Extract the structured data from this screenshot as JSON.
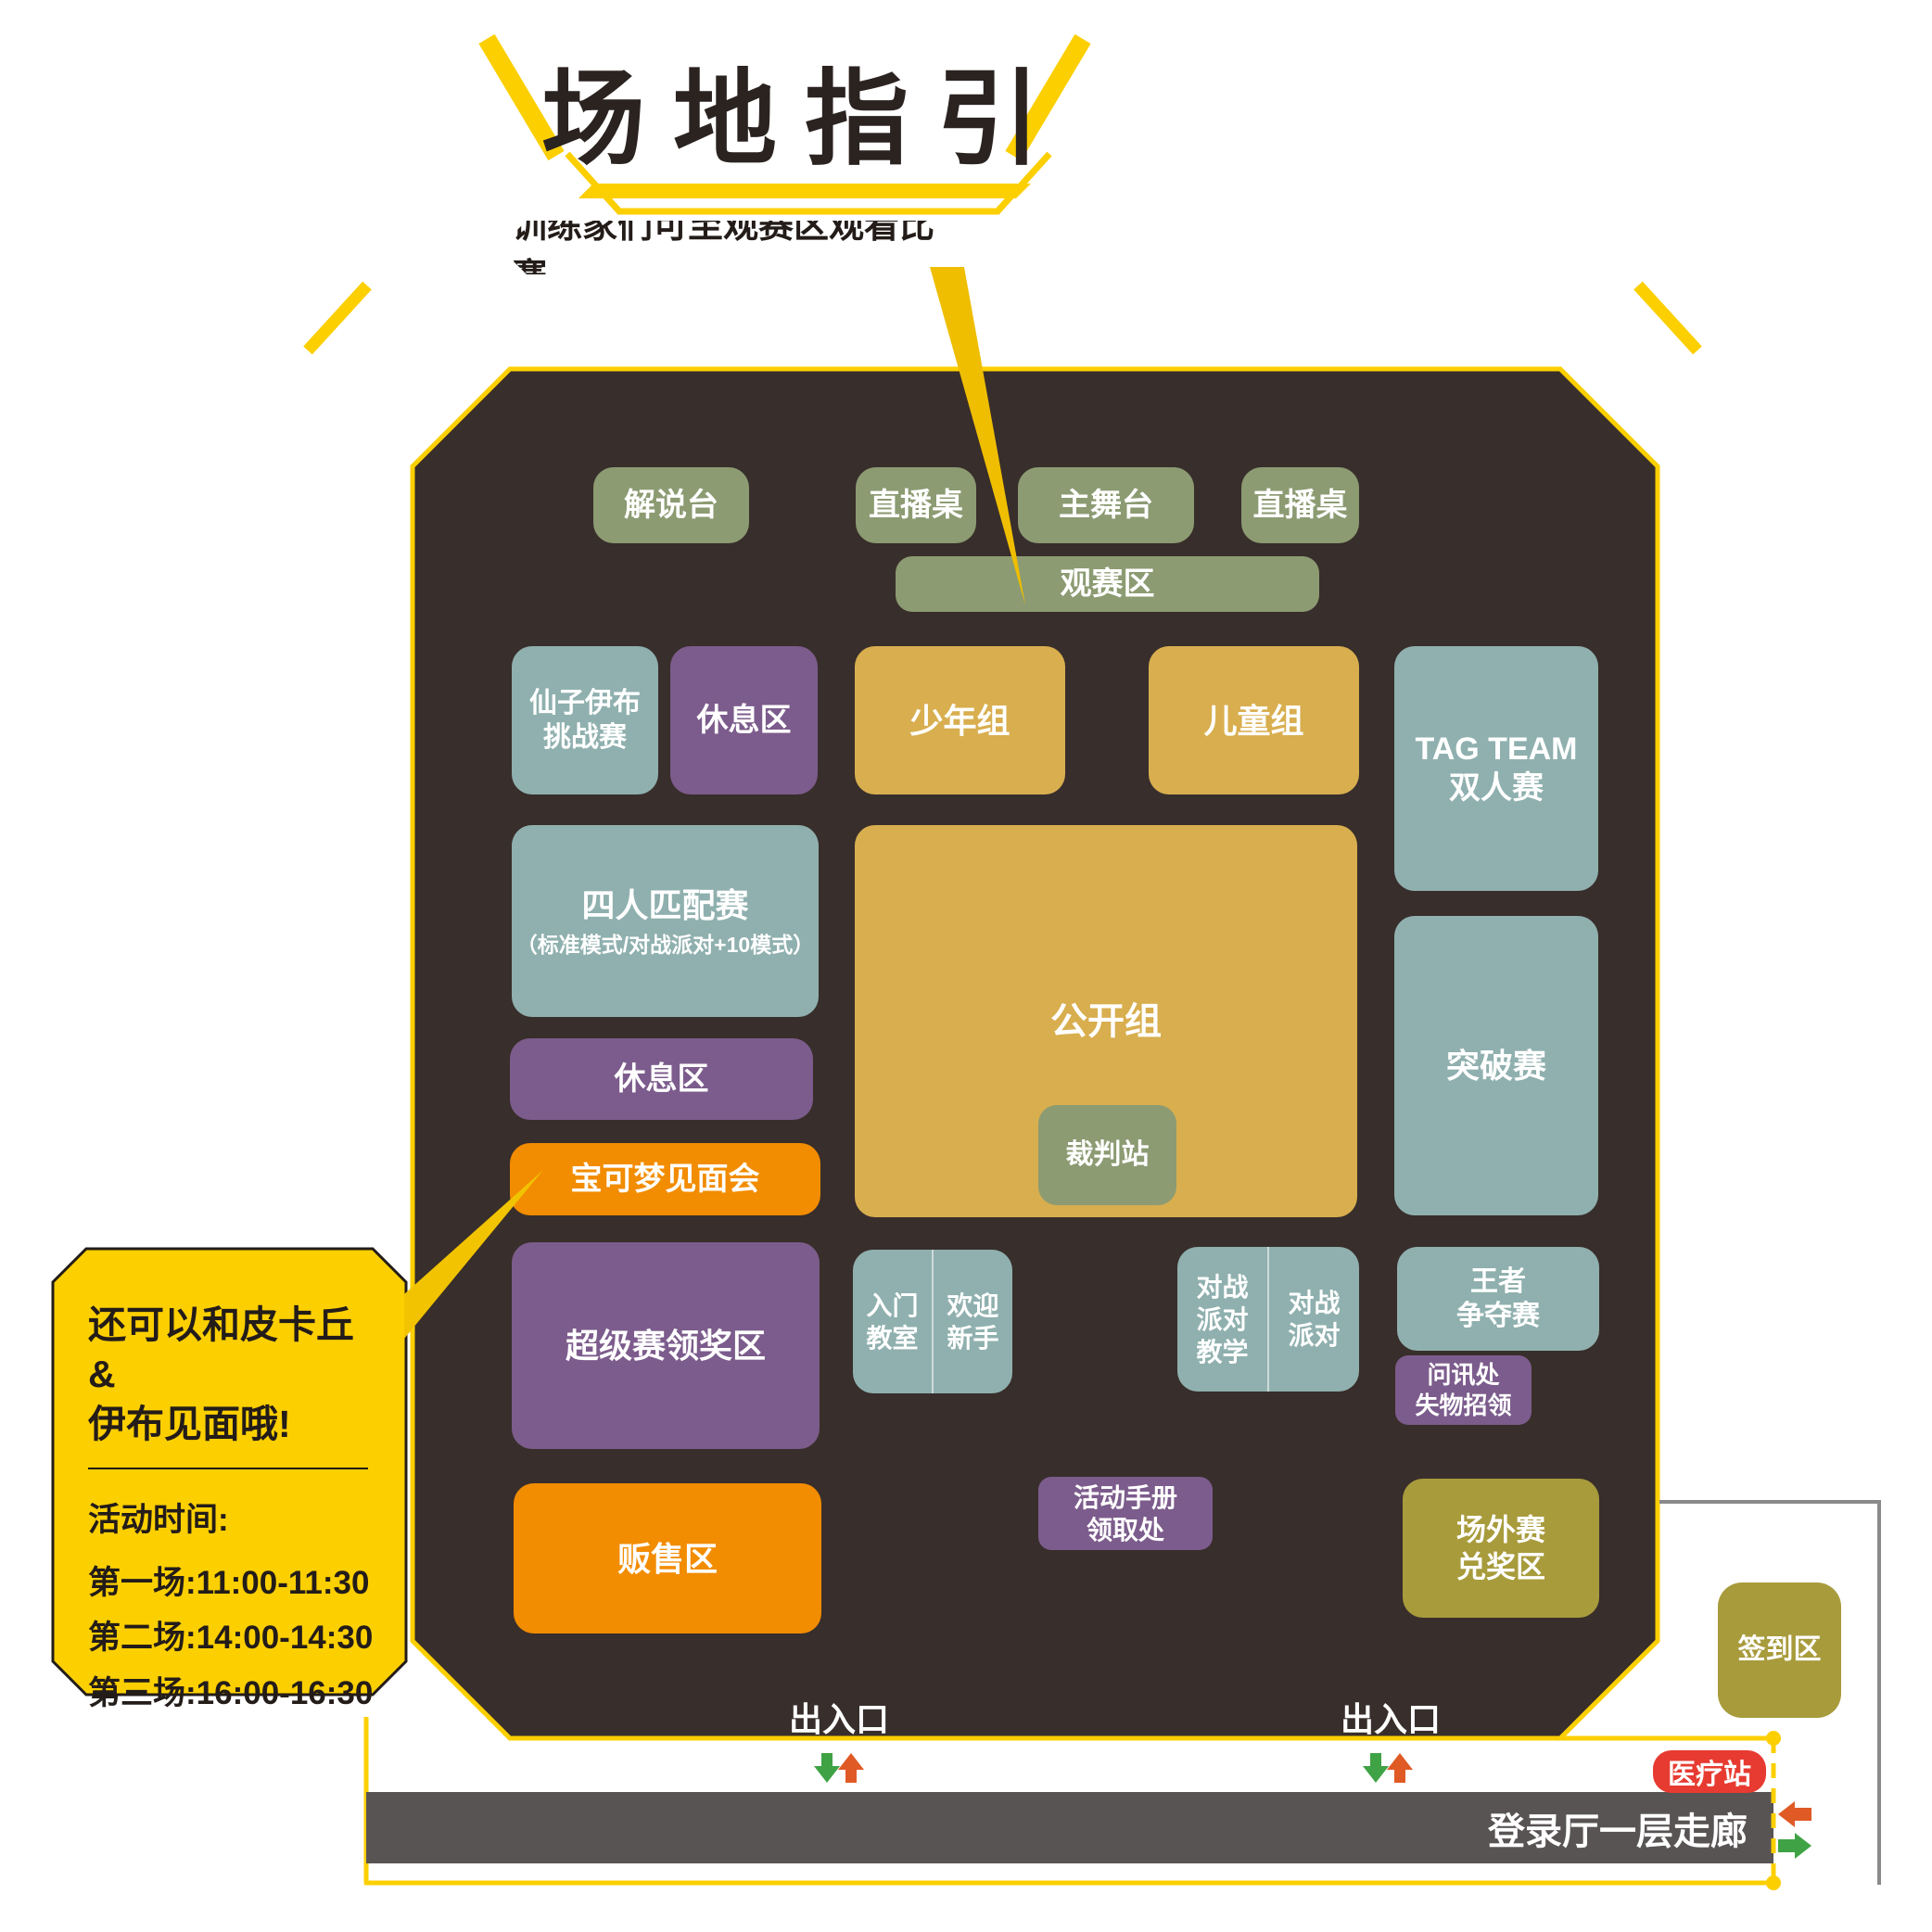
{
  "title": "场地指引",
  "callout_top": {
    "text": "训练家们可至观赛区观看比赛"
  },
  "callout_left": {
    "line1": "还可以和皮卡丘&",
    "line2": "伊布见面哦!",
    "schedule_title": "活动时间:",
    "sessions": [
      "第一场:11:00-11:30",
      "第二场:14:00-14:30",
      "第三场:16:00-16:30"
    ]
  },
  "map": {
    "stage_row": {
      "commentary": "解说台",
      "stream_a": "直播桌",
      "main_stage": "主舞台",
      "stream_b": "直播桌"
    },
    "viewing_bar": "观赛区",
    "areas": {
      "fairy": {
        "label": "仙子伊布\n挑战赛"
      },
      "rest_a": {
        "label": "休息区"
      },
      "junior": {
        "label": "少年组"
      },
      "child": {
        "label": "儿童组"
      },
      "tagteam": {
        "label": "TAG TEAM\n双人赛"
      },
      "four_match": {
        "label": "四人匹配赛",
        "sub": "（标准模式/对战派对+10模式）"
      },
      "open_group": {
        "label": "公开组"
      },
      "referee": {
        "label": "裁判站"
      },
      "breakthrough": {
        "label": "突破赛"
      },
      "rest_b": {
        "label": "休息区"
      },
      "meetup": {
        "label": "宝可梦见面会"
      },
      "premier_prize": {
        "label": "超级赛领奖区"
      },
      "beginner_class": {
        "label": "入门\n教室"
      },
      "welcome_newbie": {
        "label": "欢迎\n新手"
      },
      "party_teach": {
        "label": "对战\n派对\n教学"
      },
      "party": {
        "label": "对战\n派对"
      },
      "king_battle": {
        "label": "王者\n争夺赛"
      },
      "info_lost": {
        "label": "问讯处\n失物招领"
      },
      "handbook": {
        "label": "活动手册\n领取处"
      },
      "sales": {
        "label": "贩售区"
      },
      "outside_prize": {
        "label": "场外赛\n兑奖区"
      }
    },
    "entrance_1": "出入口",
    "entrance_2": "出入口"
  },
  "outside": {
    "checkin": "签到区",
    "medical": "医疗站",
    "corridor": "登录厅一层走廊"
  },
  "icons": {
    "entrance_arrows": [
      "arrow-down-green",
      "arrow-up-orange"
    ],
    "corridor_arrows": [
      "arrow-left-orange",
      "arrow-right-green"
    ]
  },
  "colors": {
    "accent_yellow": "#FCCF00",
    "map_background": "#382E2B",
    "stage_green": "#8C9B72",
    "zone_teal": "#8FB0AE",
    "zone_purple": "#7C5C8C",
    "zone_gold": "#D8AE4F",
    "zone_orange": "#F28C00",
    "zone_olive": "#A89B3C",
    "corridor_gray": "#595454",
    "medical_red": "#E73B31",
    "arrow_green": "#3FA345",
    "arrow_orange": "#E05A26",
    "text_dark": "#2B2320"
  }
}
